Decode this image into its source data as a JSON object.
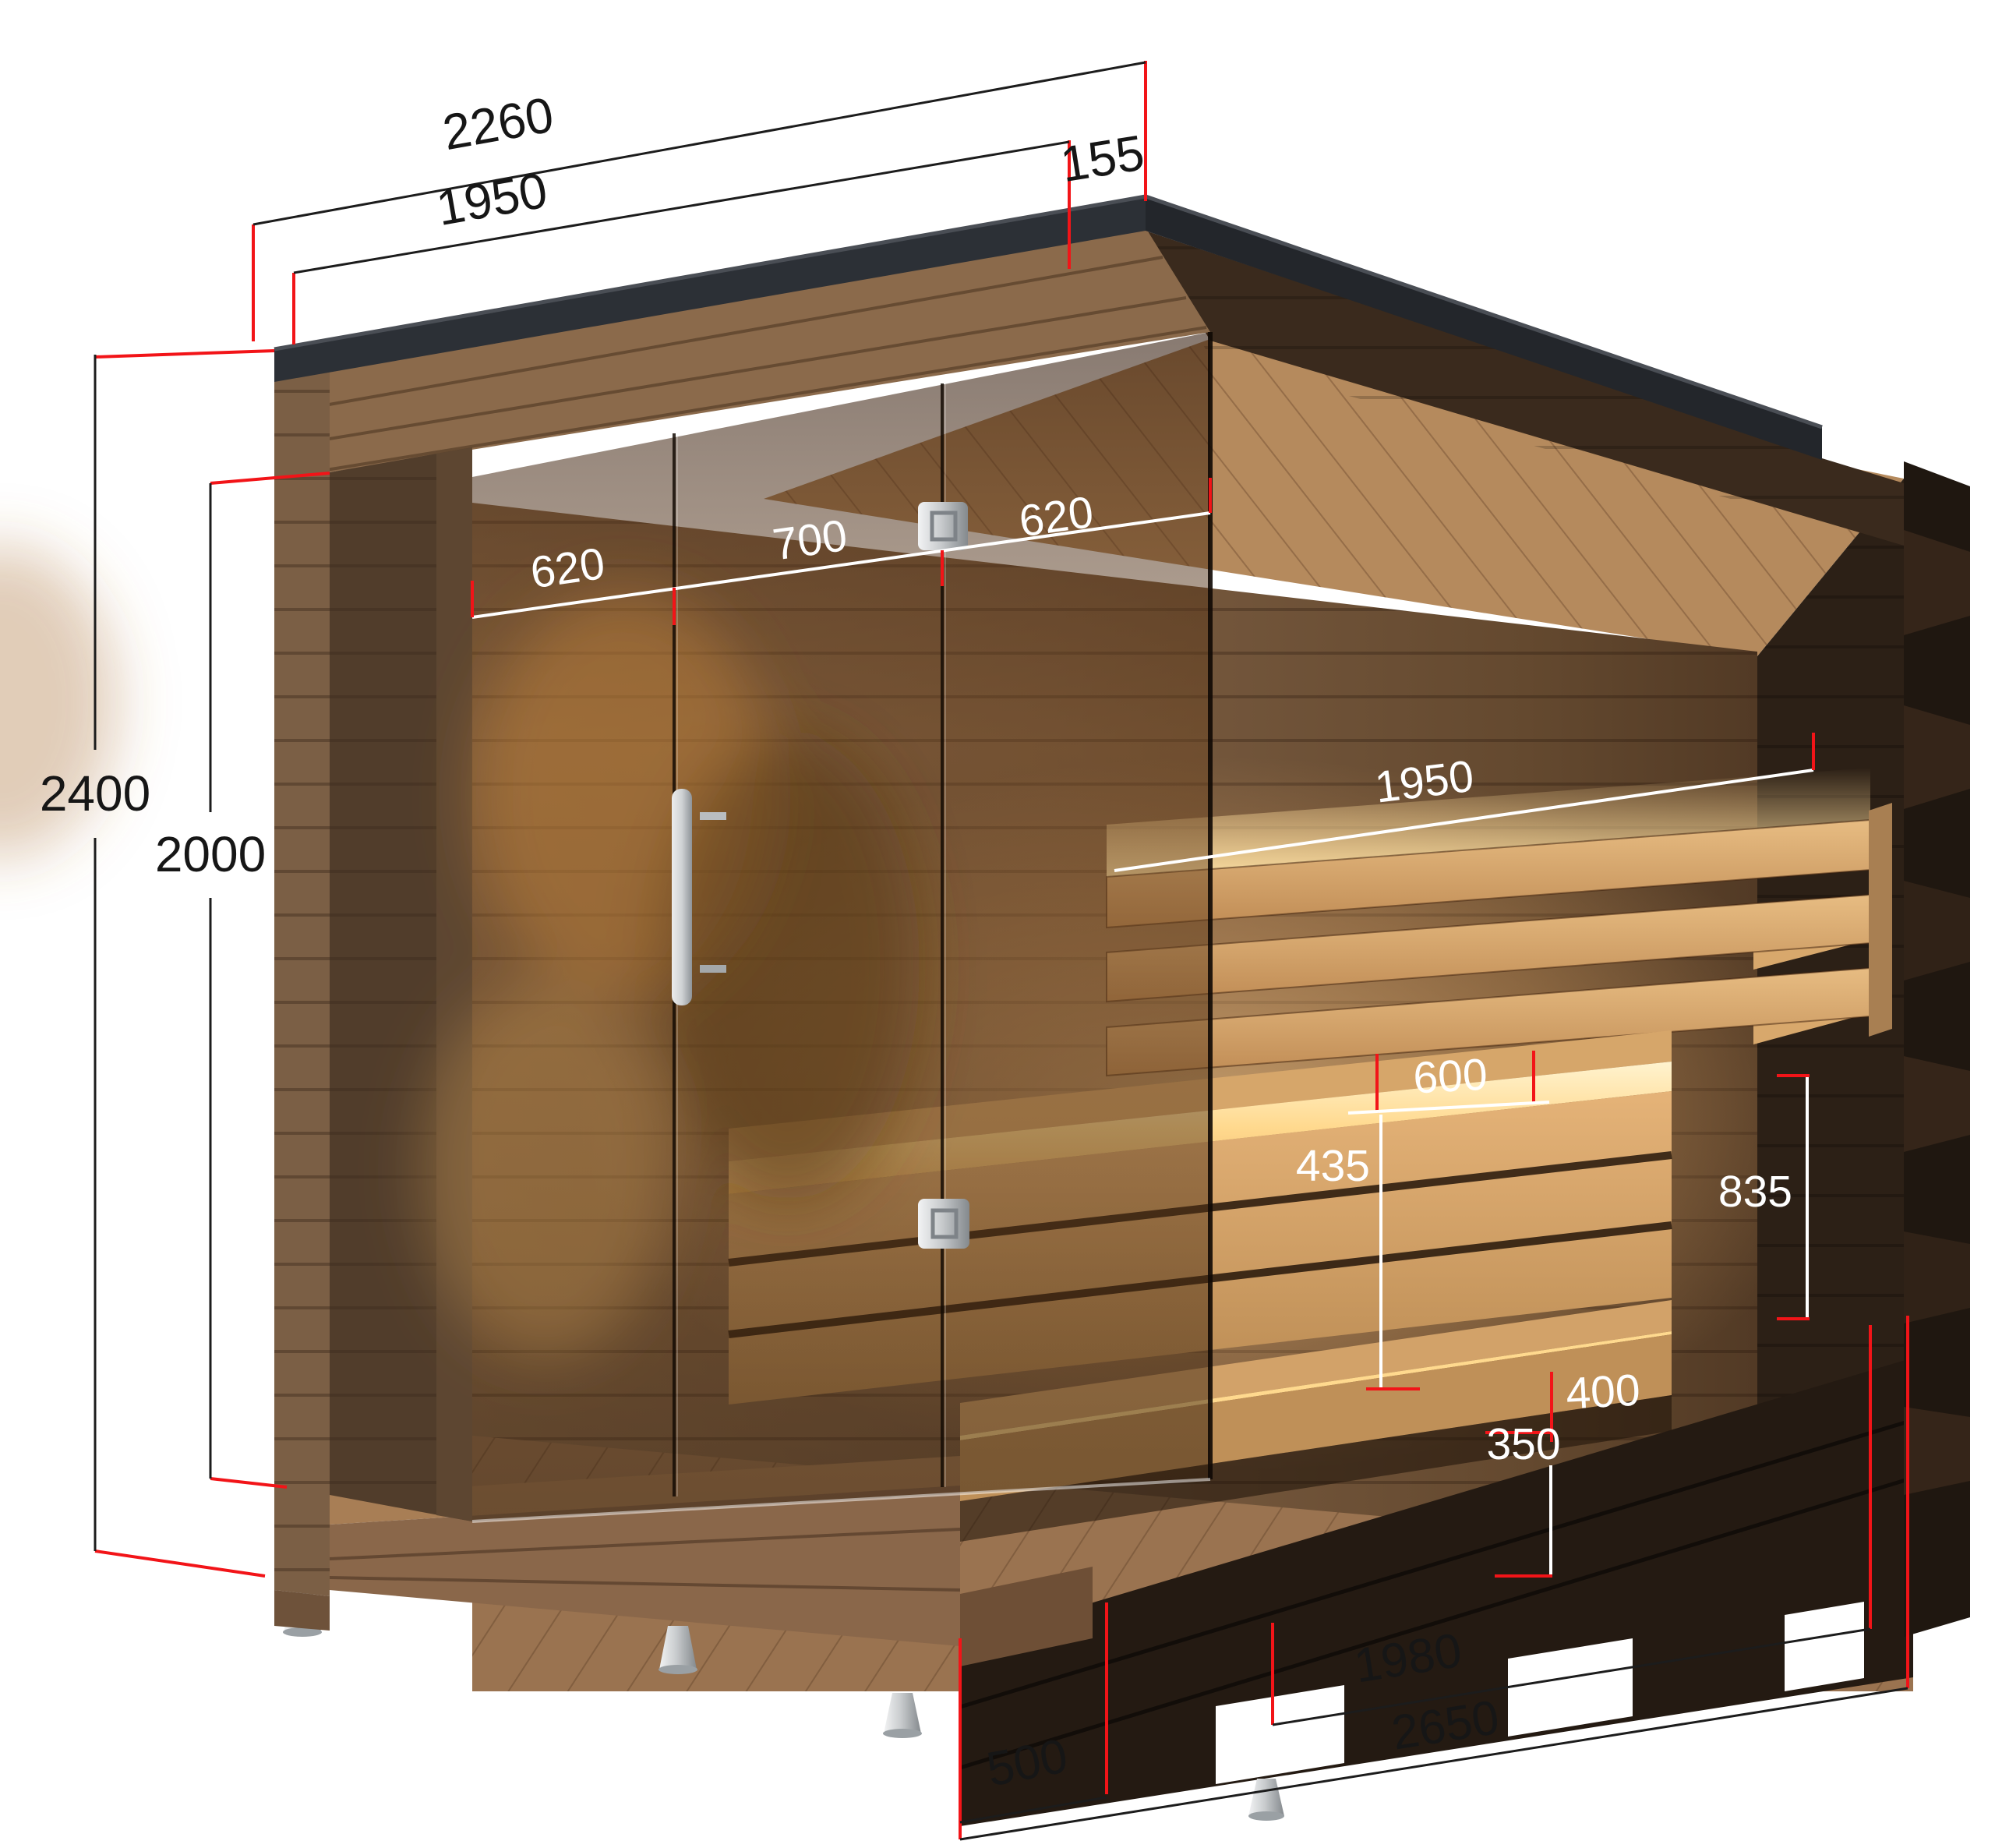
{
  "diagram": {
    "type": "product-dimension-diagram",
    "subject": "outdoor sauna cabin, cutaway view with glass front, interior benches and dimension callouts",
    "colors": {
      "background": "#ffffff",
      "dimension_line_black": "#1c1c1c",
      "dimension_extension_red": "#f21418",
      "dimension_line_white": "#ffffff",
      "roof_fascia": "#2c3036",
      "exterior_wood": "#82644a",
      "dark_stained_wood": "#32241a",
      "interior_back_wall": "#7a5c41",
      "bench_wood": "#cf9e63",
      "led_glow": "#ffd894",
      "metal_foot": "#c9ccce"
    },
    "dims": {
      "roof_depth_total": "2260",
      "roof_depth_inner": "1950",
      "roof_overhang": "155",
      "height_total": "2400",
      "height_opening": "2000",
      "glass_panel_left": "620",
      "door_width": "700",
      "glass_panel_right": "620",
      "interior_width": "1950",
      "bench_seat_depth": "600",
      "backrest_drop": "435",
      "bench_total_height": "835",
      "step_depth": "400",
      "step_height": "350",
      "base_frame_depth": "1980",
      "base_total_depth": "2650",
      "base_offset": "500"
    },
    "parts": {
      "door_handle": "vertical-bar-handle-icon",
      "door_lock_upper": "square-lock-plate-icon",
      "door_lock_lower": "square-lock-plate-icon",
      "feet": "adjustable-cone-foot-icon"
    }
  }
}
